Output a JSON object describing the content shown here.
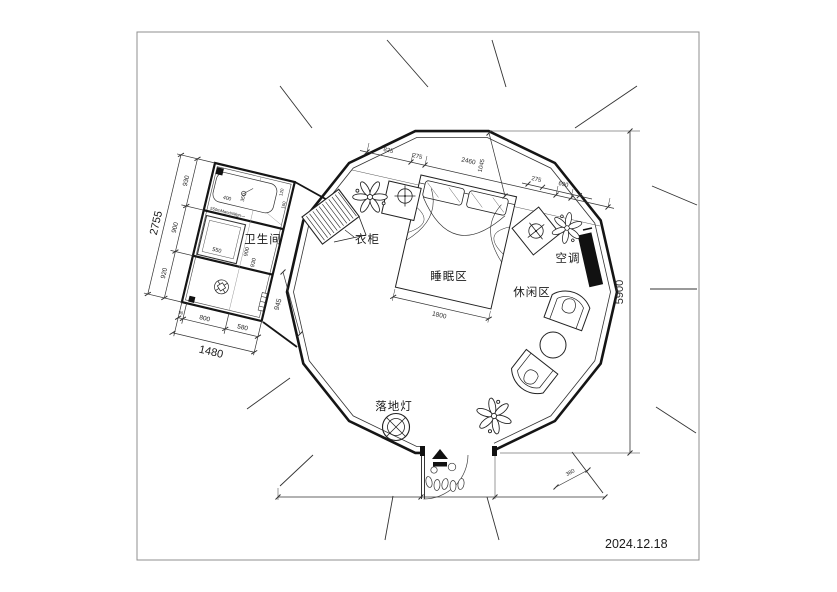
{
  "drawing": {
    "date": "2024.12.18",
    "labels": {
      "bathroom": "卫生间",
      "wardrobe": "衣柜",
      "sleeping_area": "睡眠区",
      "leisure_area": "休闲区",
      "air_conditioner": "空调",
      "floor_lamp": "落地灯"
    },
    "dims": {
      "overall_height": "5900",
      "top_run": [
        "825",
        "275",
        "2460",
        "275",
        "690"
      ],
      "headboard_depth": "1045",
      "bed_width": "1800",
      "entry_side": "380",
      "bath_left_total": "2755",
      "bath_left_segs": [
        "930",
        "900",
        "920"
      ],
      "bath_bottom_total": "1480",
      "bath_bottom_segs": [
        "90",
        "800",
        "580"
      ],
      "bath_corridor": "945",
      "bath_shower": "550",
      "bath_mid_a": "900",
      "bath_mid_b": "930",
      "bath_top_a": "400",
      "bath_top_b": "350",
      "bath_top_c": "120",
      "bath_top_d": "160",
      "bath_note": "550mMandnMgn—"
    }
  }
}
